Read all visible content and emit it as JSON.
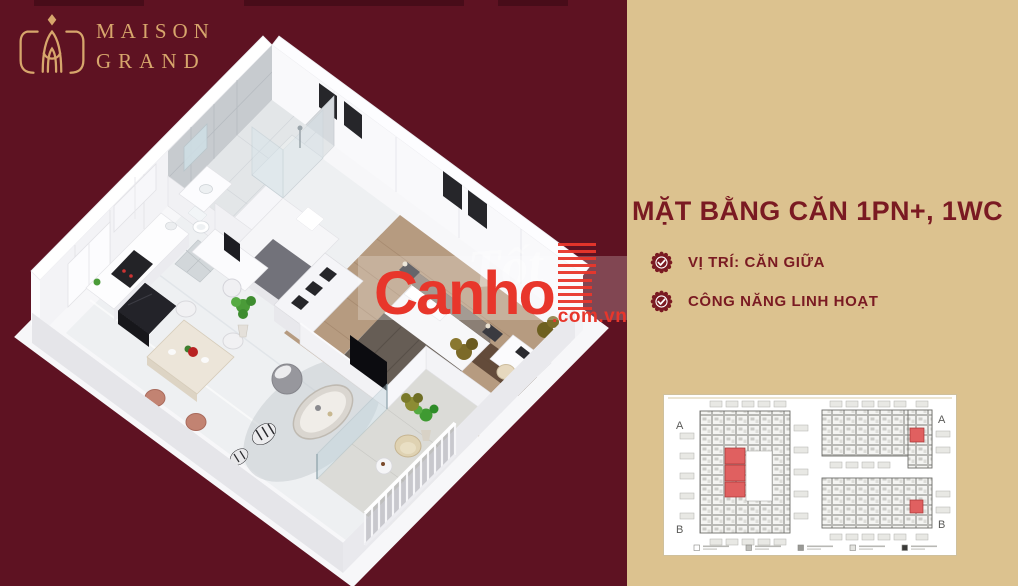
{
  "brand": {
    "name_line1": "MAISON",
    "name_line2": "GRAND"
  },
  "headline": {
    "prefix": "MẶT BẰNG CĂN ",
    "highlight": "1PN+, 1WC"
  },
  "features": [
    {
      "label": "VỊ TRÍ: CĂN GIỮA"
    },
    {
      "label": "CÔNG NĂNG LINH HOẠT"
    }
  ],
  "watermark": {
    "brand": "Canho",
    "suffix": ".com.vn",
    "faint_text": "Tốt"
  },
  "floorplan_key": {
    "tower_left": {
      "top_label": "A",
      "bottom_label": "B"
    },
    "tower_right": {
      "top_label": "A",
      "bottom_label": "B"
    },
    "highlight_color": "#e06060",
    "legend_swatches": [
      "#ffffff",
      "#c0c0bc",
      "#9a9a96",
      "#e4e4e0",
      "#3a3a38"
    ]
  },
  "colors": {
    "maroon_bg": "#5e1222",
    "beige_bg": "#dcc28f",
    "title_text": "#7a1a22",
    "logo_gold": "#d7a66c",
    "watermark_red": "#e8362b"
  }
}
